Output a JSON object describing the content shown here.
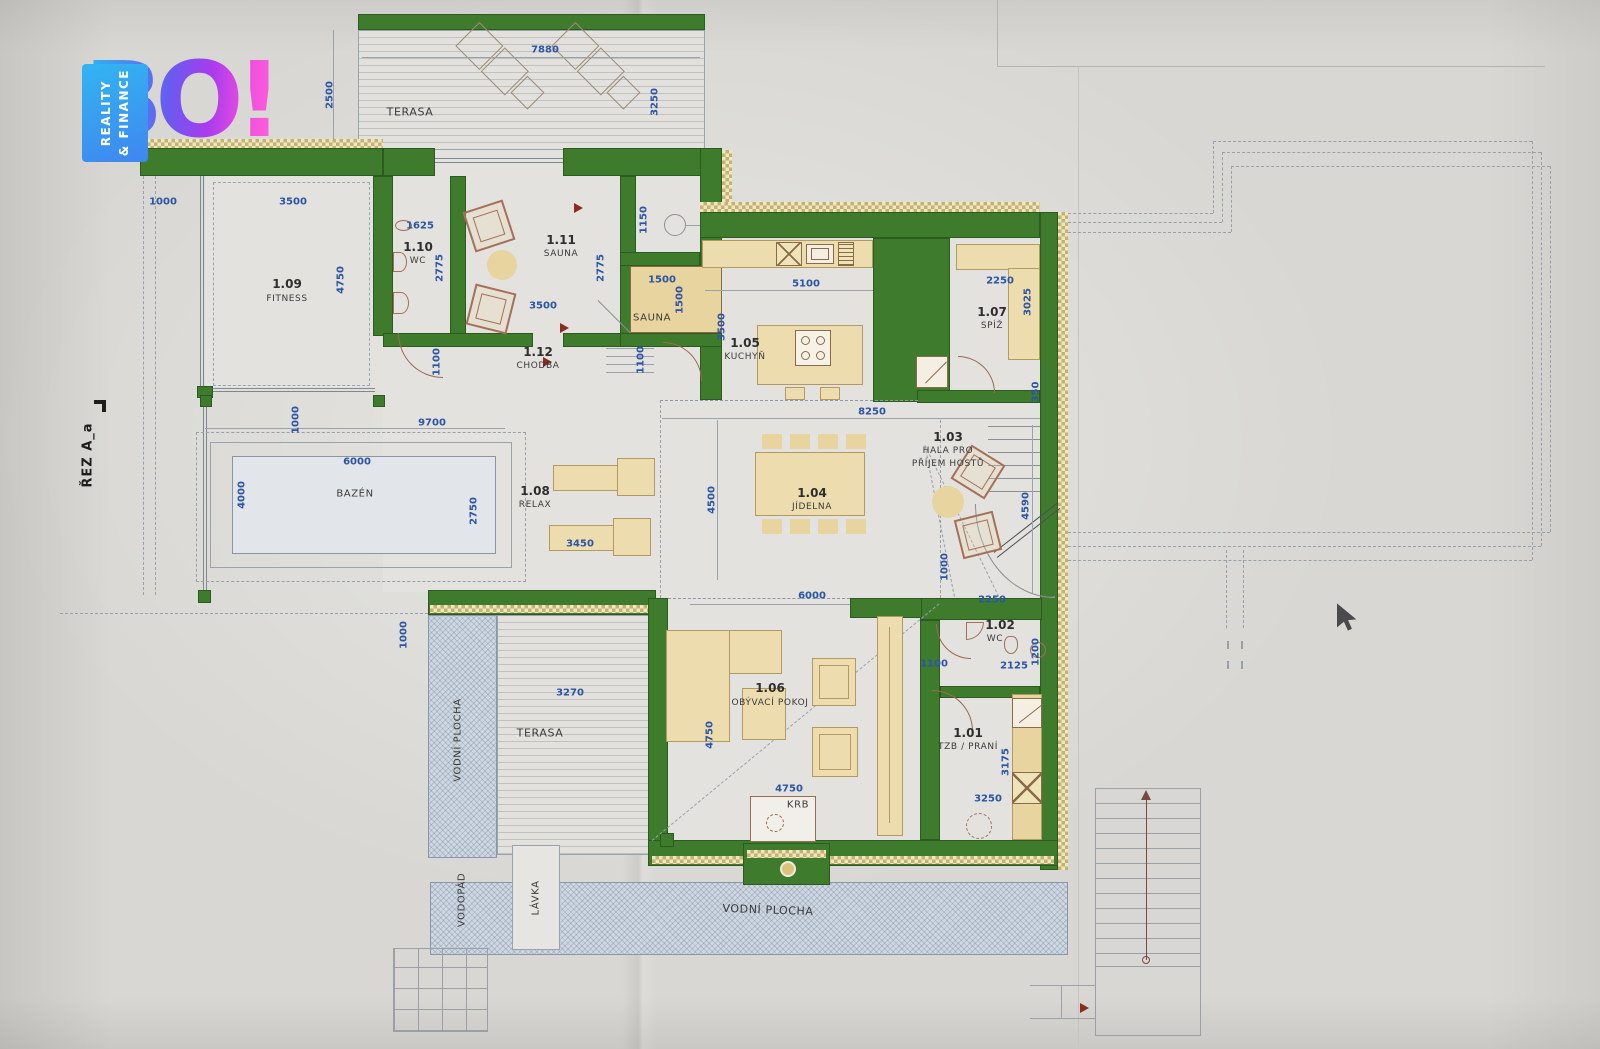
{
  "logo": {
    "brand": "BO!",
    "tagline_line1": "REALITY",
    "tagline_line2": "& FINANCE"
  },
  "section_mark": "ŘEZ A_a",
  "rooms": {
    "fitness": {
      "num": "1.09",
      "name": "FITNESS"
    },
    "wc1": {
      "num": "1.10",
      "name": "WC"
    },
    "sauna": {
      "num": "1.11",
      "name": "SAUNA"
    },
    "chodba": {
      "num": "1.12",
      "name": "CHODBA"
    },
    "kuchyn": {
      "num": "1.05",
      "name": "KUCHYŇ"
    },
    "spiz": {
      "num": "1.07",
      "name": "SPÍŽ"
    },
    "hala": {
      "num": "1.03",
      "name1": "HALA PRO",
      "name2": "PŘÍJEM HOSTŮ"
    },
    "jidelna": {
      "num": "1.04",
      "name": "JÍDELNA"
    },
    "relax": {
      "num": "1.08",
      "name": "RELAX"
    },
    "obyvaci": {
      "num": "1.06",
      "name": "OBÝVACÍ POKOJ"
    },
    "wc2": {
      "num": "1.02",
      "name": "WC"
    },
    "tzb": {
      "num": "1.01",
      "name": "TZB / PRANÍ"
    }
  },
  "areas": {
    "terasa_top": "TERASA",
    "terasa_bottom": "TERASA",
    "bazen": "BAZÉN",
    "sauna_box": "SAUNA",
    "krb": "KRB",
    "vodni_vert": "VODNÍ PLOCHA",
    "vodni_horiz": "VODNÍ PLOCHA",
    "vodopad": "VODOPÁD",
    "lavka": "LÁVKA"
  },
  "dims": {
    "t_w": "7880",
    "t_h_l": "2500",
    "t_h_r": "3250",
    "fit_left": "1000",
    "fit_top": "3500",
    "fit_v": "4750",
    "wc1_top": "1625",
    "wc1_v": "2775",
    "wc1_b": "1100",
    "sau_b": "3500",
    "sau_v": "2775",
    "shower_v": "1150",
    "sbox_w": "1500",
    "sbox_h": "1500",
    "chod_v": "1100",
    "kit_top": "5100",
    "kit_v": "3500",
    "spiz_top": "2250",
    "spiz_v": "3025",
    "spiz_b": "350",
    "hala_top": "8250",
    "hala_v": "4590",
    "hala_bl": "1000",
    "stairs_b": "2250",
    "jid_v": "4500",
    "jid_b": "6000",
    "pool_out": "9700",
    "pool_w": "6000",
    "pool_l": "4000",
    "pool_r": "2750",
    "pool_tl": "1000",
    "relax_b": "3450",
    "ter_l": "1000",
    "ter_b_top": "3270",
    "liv_v": "4750",
    "liv_b": "4750",
    "liv_r": "1100",
    "wc2_w": "2125",
    "wc2_v": "1200",
    "tzb_v": "3175",
    "tzb_b": "3250"
  }
}
